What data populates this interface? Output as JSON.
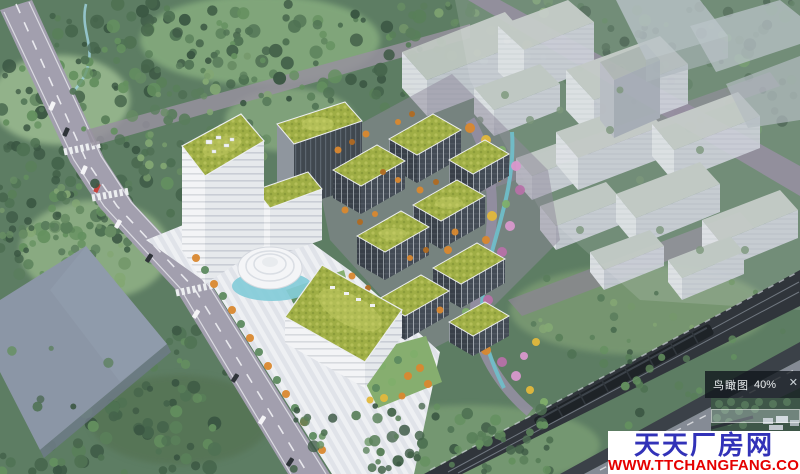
{
  "navigator": {
    "title": "鸟瞰图",
    "zoom_level": "40%",
    "close_glyph": "✕"
  },
  "watermark": {
    "brand_name": "天天厂房网",
    "website": "WWW.TTCHANGFANG.COM",
    "brand_color": "#3232b8",
    "website_color": "#e50000",
    "panel_background": "#ffffff"
  },
  "scene": {
    "type": "aerial-architectural-rendering",
    "palette": {
      "forest_green": "#4a6b50",
      "meadow_green": "#9cbd8e",
      "grass_roof": "#a2b04a",
      "road_gray": "#a29fae",
      "plaza_white": "#eef0f3",
      "ghost_building_gray": "#c8cdd5",
      "railway_dark": "#30353b",
      "water_teal": "#6fc0cc",
      "tree_orange": "#d9882f",
      "tree_pink": "#d898cc",
      "tree_yellow": "#e2b83c"
    }
  }
}
